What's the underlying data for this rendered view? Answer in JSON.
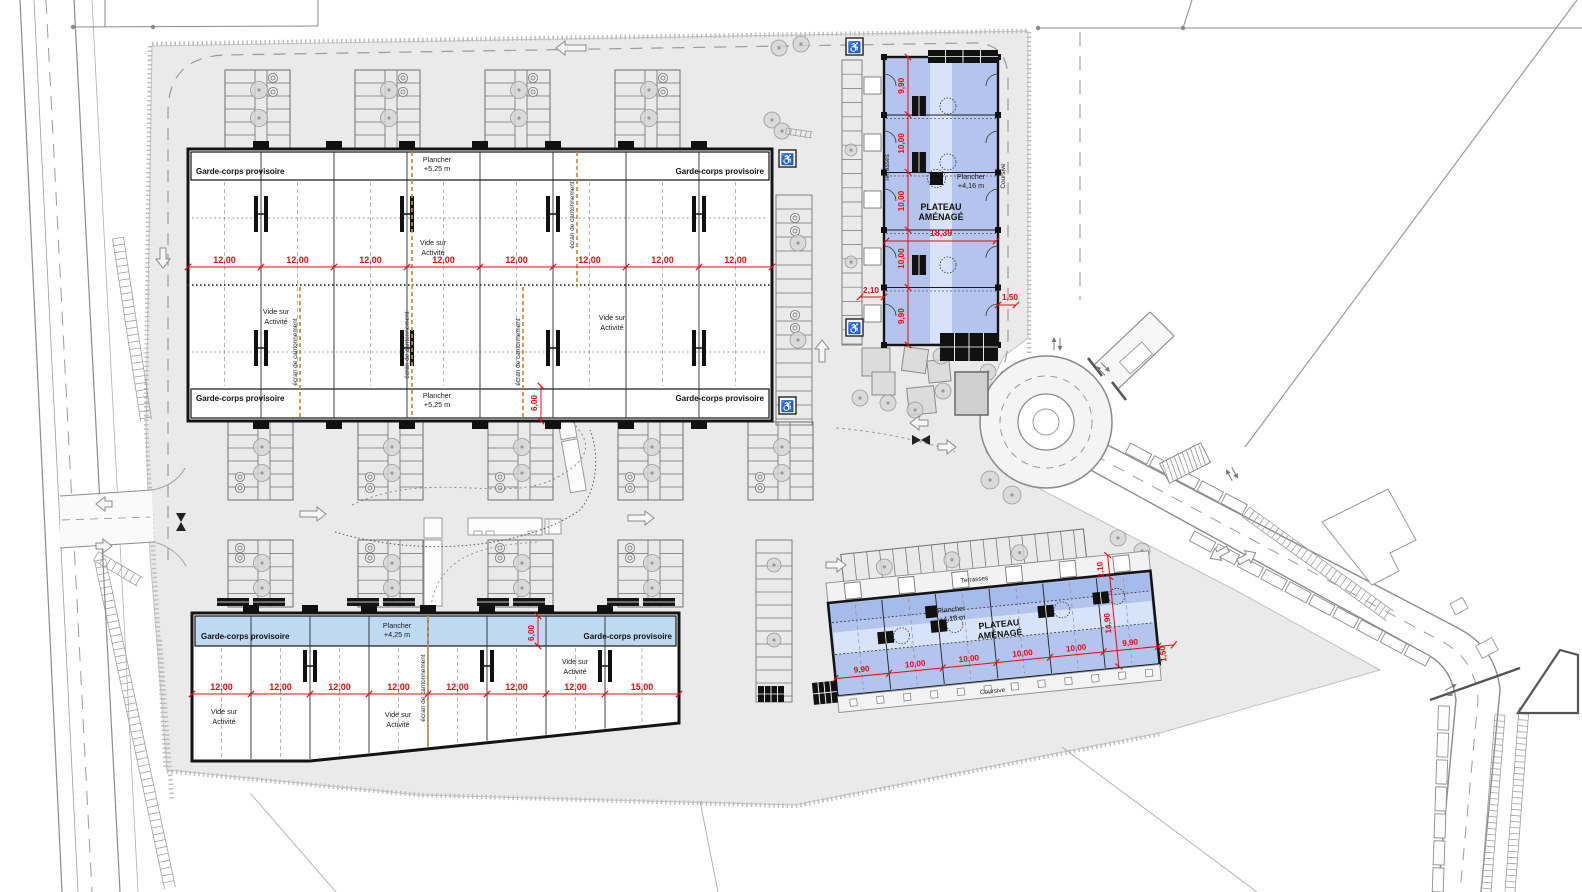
{
  "colors": {
    "site_fill": "#eaeaea",
    "road_line": "#8c8c8c",
    "boundary": "#a8a8a8",
    "building_outline": "#141414",
    "band_blue": "#bfd9f2",
    "plateau_blue": "#b3c5ee",
    "plateau_stripe": "#d6e3f8",
    "plateau_dark": "#a6bbea",
    "dim_red": "#e60b0b",
    "ecran_orange": "#cf8a33",
    "tree": "#d4d4d4",
    "black_block": "#111111"
  },
  "buildings": {
    "top_left": {
      "garde_corps": "Garde-corps provisoire",
      "plancher": "Plancher",
      "plancher_level": "+5,25 m",
      "vide_1": "Vide sur",
      "vide_2": "Activité",
      "ecran": "écran de cantonnement",
      "bays": [
        "12,00",
        "12,00",
        "12,00",
        "12,00",
        "12,00",
        "12,00",
        "12,00",
        "12,00"
      ],
      "edge_dim": "6,00"
    },
    "bottom_left": {
      "garde_corps": "Garde-corps provisoire",
      "plancher": "Plancher",
      "plancher_level": "+4,25 m",
      "vide_1": "Vide sur",
      "vide_2": "Activité",
      "ecran": "écran de cantonnement",
      "bays": [
        "12,00",
        "12,00",
        "12,00",
        "12,00",
        "12,00",
        "12,00",
        "12,00",
        "15,00"
      ],
      "edge_dim": "6,00"
    },
    "top_right": {
      "title_1": "PLATEAU",
      "title_2": "AMÉNAGÉ",
      "plancher": "Plancher",
      "plancher_level": "+4,16 m",
      "terrasses": "Terrasses",
      "coursive": "Coursive",
      "bays": [
        "9,90",
        "10,00",
        "10,00",
        "10,00",
        "9,90"
      ],
      "width_dim": "18,39",
      "offset_left": "2,10",
      "offset_right": "1,50"
    },
    "bottom_right": {
      "title_1": "PLATEAU",
      "title_2": "AMÉNAGÉ",
      "plancher": "Plancher",
      "plancher_level": "+4,16 m",
      "terrasses": "Terrasses",
      "coursive": "Coursive",
      "bays": [
        "9,90",
        "10,00",
        "10,00",
        "10,00",
        "10,00",
        "9,90"
      ],
      "depth_dim": "14,90",
      "offset_top": "2,10",
      "offset_right": "1,50"
    }
  },
  "icons": {
    "accessible_parking": "♿"
  }
}
